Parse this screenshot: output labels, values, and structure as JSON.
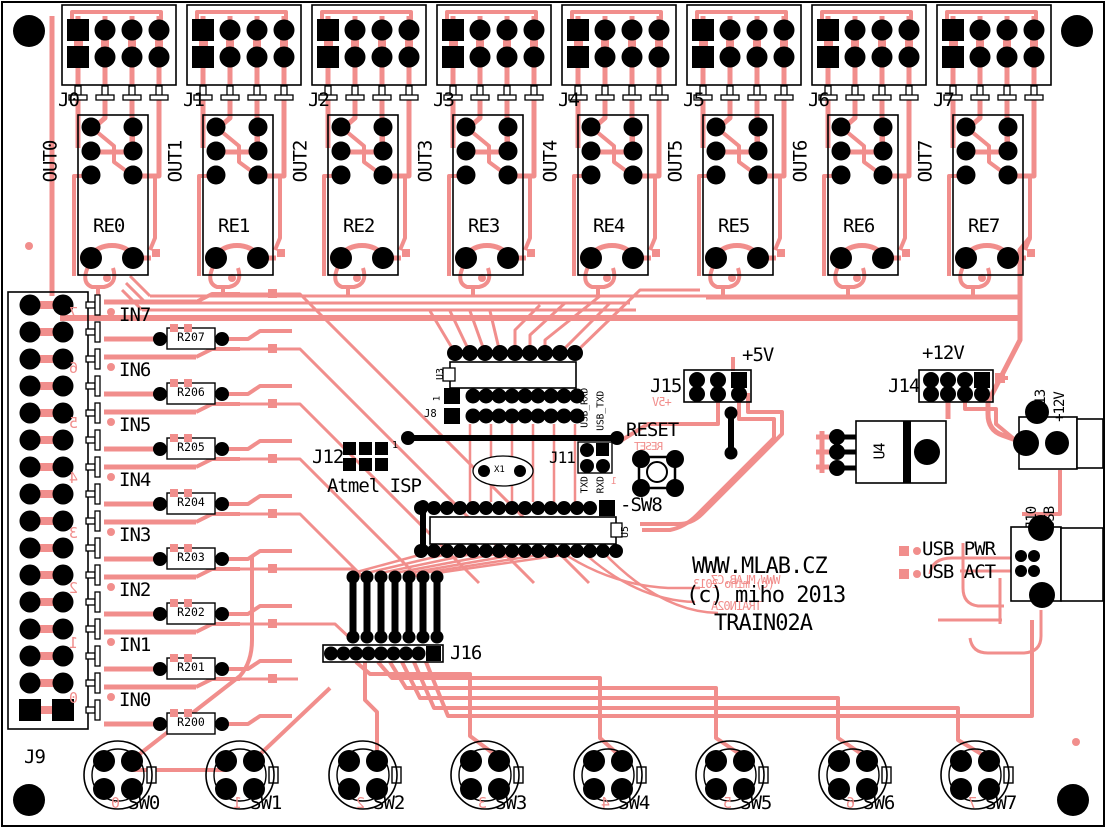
{
  "board": {
    "trace_color": "#F18E8C",
    "silk_color": "#000000",
    "name": "TRAIN02A"
  },
  "relay_blocks": [
    {
      "connector": "J0",
      "output": "OUT0",
      "relay": "RE0"
    },
    {
      "connector": "J1",
      "output": "OUT1",
      "relay": "RE1"
    },
    {
      "connector": "J2",
      "output": "OUT2",
      "relay": "RE2"
    },
    {
      "connector": "J3",
      "output": "OUT3",
      "relay": "RE3"
    },
    {
      "connector": "J4",
      "output": "OUT4",
      "relay": "RE4"
    },
    {
      "connector": "J5",
      "output": "OUT5",
      "relay": "RE5"
    },
    {
      "connector": "J6",
      "output": "OUT6",
      "relay": "RE6"
    },
    {
      "connector": "J7",
      "output": "OUT7",
      "relay": "RE7"
    }
  ],
  "input_section": {
    "connector_label": "J9",
    "channels": [
      {
        "label": "IN7",
        "resistor": "R207",
        "mirror_digit": "7"
      },
      {
        "label": "IN6",
        "resistor": "R206",
        "mirror_digit": "6"
      },
      {
        "label": "IN5",
        "resistor": "R205",
        "mirror_digit": "5"
      },
      {
        "label": "IN4",
        "resistor": "R204",
        "mirror_digit": "4"
      },
      {
        "label": "IN3",
        "resistor": "R203",
        "mirror_digit": "3"
      },
      {
        "label": "IN2",
        "resistor": "R202",
        "mirror_digit": "2"
      },
      {
        "label": "IN1",
        "resistor": "R201",
        "mirror_digit": "1"
      },
      {
        "label": "IN0",
        "resistor": "R200",
        "mirror_digit": "0"
      }
    ]
  },
  "center": {
    "u3": "U3",
    "u3_pin1": "1",
    "j8": "J8",
    "j12": "J12",
    "j12_pin1": "1",
    "isp": "Atmel ISP",
    "x1": "X1",
    "j11": "J11",
    "usb_rxd": "USB_RXD",
    "usb_txd": "USB_TXD",
    "txd": "TXD",
    "rxd": "RXD",
    "reset": "RESET",
    "reset_mirror": "RESET",
    "sw8": "-SW8",
    "sw8_mirror_pin": "1",
    "u5": "U5",
    "j16": "J16"
  },
  "power": {
    "plus5": "+5V",
    "j15": "J15",
    "plus5_mirror": "+5V",
    "plus12": "+12V",
    "j14": "J14",
    "u4": "U4",
    "j13": "J13",
    "j13_voltage": "+12V",
    "j10": "J10",
    "j10_type": "USB",
    "usb_pwr": "USB PWR",
    "usb_act": "USB ACT"
  },
  "branding": {
    "line1": "WWW.MLAB.CZ",
    "line2": "(c) miho 2013",
    "line3": "TRAIN02A",
    "mirror_line1": "WWW.MLAB.CZ",
    "mirror_line2": "(c) miho 2013",
    "mirror_line3": "TRAIN02A"
  },
  "switches": [
    {
      "label": "SW0",
      "mirror_digit": "0"
    },
    {
      "label": "SW1",
      "mirror_digit": "1"
    },
    {
      "label": "SW2",
      "mirror_digit": "2"
    },
    {
      "label": "SW3",
      "mirror_digit": "3"
    },
    {
      "label": "SW4",
      "mirror_digit": "4"
    },
    {
      "label": "SW5",
      "mirror_digit": "5"
    },
    {
      "label": "SW6",
      "mirror_digit": "6"
    },
    {
      "label": "SW7",
      "mirror_digit": "7"
    }
  ]
}
